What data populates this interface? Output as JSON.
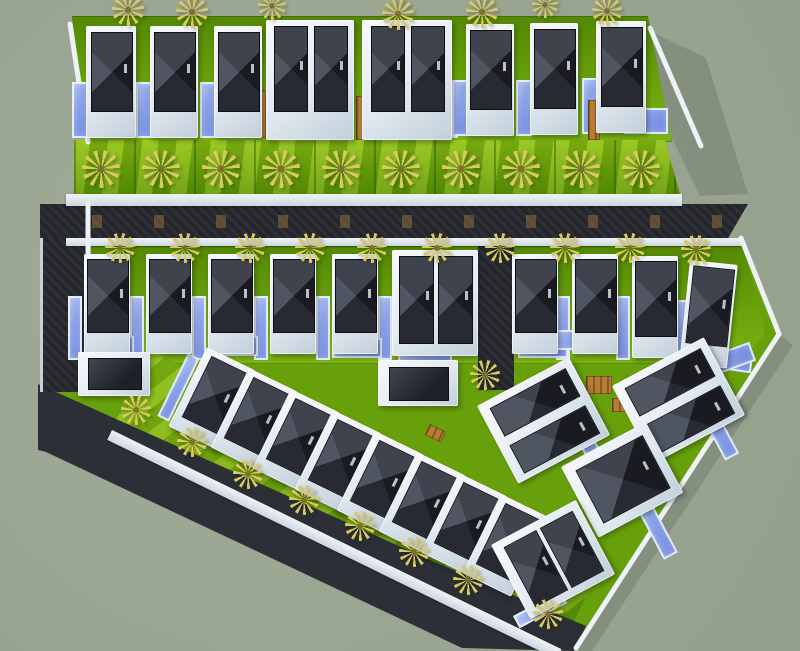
{
  "meta": {
    "description": "3D aerial top-down render of a tropical villa development master plan",
    "width": 800,
    "height": 651,
    "legend": {
      "top_row_villas": 8,
      "middle_row_villas": 10,
      "diagonal_row_villas": 8,
      "right_cluster_villas": 4,
      "garages": 2,
      "swimming_pools": 38,
      "palm_trees": 36
    }
  },
  "palette": {
    "background_sage": "#9aa592",
    "asphalt_road": "#26282f",
    "lawn_bright": "#7ab411",
    "lawn_dark": "#548804",
    "pool_blue": "#8aa1e8",
    "roof_dark": "#191b21",
    "roof_light_facet": "#4f5561",
    "villa_white": "#f7fafc",
    "wood_deck": "#b57d36",
    "palm_yellow": "#d9c95e",
    "sidewalk_white": "#f0f4f7"
  },
  "scene": {
    "greens": [
      {
        "kind": "backing",
        "rect": [
          72,
          16,
          600,
          126
        ],
        "clip": "polygon(0 0, 96% 0, 100% 100%, 2.7% 100%)"
      },
      {
        "kind": "strip",
        "rect": [
          74,
          140,
          606,
          54
        ],
        "clip": "polygon(0 0, 97.5% 0, 100% 100%, 0 100%)"
      },
      {
        "kind": "backing",
        "rect": [
          66,
          246,
          700,
          118
        ],
        "clip": "polygon(0 0, 96.8% 0, 100% 74%, 95.8% 100%, 0 100%)"
      },
      {
        "kind": "band",
        "rect": [
          150,
          350,
          500,
          100,
          26
        ]
      }
    ],
    "roads": {
      "left": {
        "id": "road-left",
        "rect": [
          40,
          204,
          46,
          188
        ]
      },
      "mid": {
        "id": "road-mid",
        "rect": [
          40,
          204,
          708,
          34
        ],
        "clip": "polygon(0 0, 100% 0, 97.2% 100%, 0 100%)"
      },
      "alley": {
        "id": "road-alley",
        "rect": [
          478,
          238,
          36,
          152
        ]
      }
    },
    "sidewalks": [
      [
        66,
        194,
        616,
        12
      ],
      [
        66,
        238,
        676,
        8
      ],
      [
        112,
        430,
        500,
        11,
        26
      ]
    ],
    "pools": [
      [
        72,
        82,
        16,
        56
      ],
      [
        136,
        82,
        16,
        56
      ],
      [
        200,
        82,
        16,
        56
      ],
      [
        300,
        112,
        46,
        26
      ],
      [
        412,
        112,
        46,
        26
      ],
      [
        452,
        80,
        16,
        56
      ],
      [
        516,
        80,
        16,
        56
      ],
      [
        582,
        78,
        16,
        56
      ],
      [
        624,
        108,
        44,
        26
      ],
      [
        68,
        296,
        14,
        64
      ],
      [
        130,
        296,
        14,
        64
      ],
      [
        192,
        296,
        14,
        64
      ],
      [
        254,
        296,
        14,
        64
      ],
      [
        316,
        296,
        14,
        64
      ],
      [
        378,
        296,
        14,
        64
      ],
      [
        556,
        296,
        14,
        64
      ],
      [
        616,
        296,
        14,
        64
      ],
      [
        676,
        300,
        14,
        64
      ],
      [
        84,
        336,
        50,
        20
      ],
      [
        208,
        336,
        50,
        20
      ],
      [
        332,
        338,
        50,
        20
      ],
      [
        398,
        352,
        54,
        20
      ],
      [
        518,
        338,
        50,
        20
      ],
      [
        700,
        346,
        54,
        20,
        8
      ],
      [
        188,
        353,
        13,
        70,
        26
      ],
      [
        230,
        374,
        13,
        70,
        26
      ],
      [
        272,
        395,
        13,
        70,
        26
      ],
      [
        314,
        416,
        13,
        70,
        26
      ],
      [
        356,
        437,
        13,
        70,
        26
      ],
      [
        398,
        458,
        13,
        70,
        26
      ],
      [
        440,
        479,
        13,
        70,
        26
      ],
      [
        482,
        500,
        13,
        70,
        26
      ],
      [
        563,
        414,
        16,
        84,
        -28
      ],
      [
        696,
        406,
        16,
        62,
        -28
      ],
      [
        631,
        498,
        16,
        70,
        -28
      ],
      [
        513,
        616,
        54,
        14,
        -28
      ],
      [
        691,
        363,
        62,
        20,
        -20
      ],
      [
        548,
        330,
        58,
        20
      ]
    ],
    "decks": [
      [
        252,
        90,
        14,
        48
      ],
      [
        356,
        96,
        14,
        44
      ],
      [
        588,
        100,
        12,
        40
      ],
      [
        586,
        376,
        26,
        18
      ],
      [
        612,
        398,
        20,
        14
      ],
      [
        430,
        424,
        18,
        12,
        26
      ]
    ],
    "buildings": [
      {
        "rect": [
          86,
          26,
          50,
          112
        ],
        "roofs": [
          [
            5,
            6,
            40,
            78
          ]
        ]
      },
      {
        "rect": [
          150,
          26,
          48,
          112
        ],
        "roofs": [
          [
            4,
            6,
            40,
            78
          ]
        ]
      },
      {
        "rect": [
          214,
          26,
          48,
          112
        ],
        "roofs": [
          [
            4,
            6,
            40,
            78
          ]
        ]
      },
      {
        "rect": [
          266,
          20,
          88,
          120
        ],
        "roofs": [
          [
            8,
            6,
            32,
            84
          ],
          [
            48,
            6,
            32,
            84
          ]
        ]
      },
      {
        "rect": [
          362,
          20,
          90,
          120
        ],
        "roofs": [
          [
            9,
            6,
            32,
            84
          ],
          [
            49,
            6,
            32,
            84
          ]
        ]
      },
      {
        "rect": [
          466,
          24,
          48,
          112
        ],
        "roofs": [
          [
            4,
            6,
            40,
            78
          ]
        ]
      },
      {
        "rect": [
          530,
          23,
          48,
          112
        ],
        "roofs": [
          [
            4,
            6,
            40,
            78
          ]
        ]
      },
      {
        "rect": [
          596,
          21,
          50,
          112
        ],
        "roofs": [
          [
            5,
            6,
            40,
            78
          ]
        ]
      },
      {
        "rect": [
          84,
          254,
          46,
          100
        ],
        "roofs": [
          [
            3,
            5,
            40,
            72
          ]
        ]
      },
      {
        "rect": [
          146,
          254,
          46,
          100
        ],
        "roofs": [
          [
            3,
            5,
            40,
            72
          ]
        ]
      },
      {
        "rect": [
          208,
          254,
          46,
          100
        ],
        "roofs": [
          [
            3,
            5,
            40,
            72
          ]
        ]
      },
      {
        "rect": [
          270,
          254,
          46,
          100
        ],
        "roofs": [
          [
            3,
            5,
            40,
            72
          ]
        ]
      },
      {
        "rect": [
          332,
          254,
          46,
          100
        ],
        "roofs": [
          [
            3,
            5,
            40,
            72
          ]
        ]
      },
      {
        "rect": [
          392,
          250,
          86,
          106
        ],
        "roofs": [
          [
            7,
            6,
            33,
            86
          ],
          [
            46,
            6,
            33,
            86
          ]
        ]
      },
      {
        "rect": [
          512,
          254,
          46,
          100
        ],
        "roofs": [
          [
            3,
            5,
            40,
            72
          ]
        ]
      },
      {
        "rect": [
          572,
          254,
          46,
          100
        ],
        "roofs": [
          [
            3,
            5,
            40,
            72
          ]
        ]
      },
      {
        "rect": [
          632,
          256,
          46,
          102
        ],
        "roofs": [
          [
            3,
            5,
            40,
            74
          ]
        ]
      },
      {
        "rect": [
          690,
          260,
          48,
          104,
          6
        ],
        "roofs": [
          [
            4,
            5,
            40,
            76
          ]
        ]
      },
      {
        "rect": [
          78,
          352,
          72,
          44
        ],
        "flat": true,
        "roofs": [
          [
            10,
            6,
            52,
            30
          ]
        ]
      },
      {
        "rect": [
          378,
          360,
          80,
          46
        ],
        "flat": true,
        "roofs": [
          [
            11,
            7,
            58,
            32
          ]
        ]
      },
      {
        "rect": [
          207,
          347,
          54,
          88,
          26
        ],
        "roofs": [
          [
            8,
            6,
            38,
            66
          ]
        ]
      },
      {
        "rect": [
          249,
          368,
          54,
          88,
          26
        ],
        "roofs": [
          [
            8,
            6,
            38,
            66
          ]
        ]
      },
      {
        "rect": [
          291,
          389,
          54,
          88,
          26
        ],
        "roofs": [
          [
            8,
            6,
            38,
            66
          ]
        ]
      },
      {
        "rect": [
          333,
          410,
          54,
          88,
          26
        ],
        "roofs": [
          [
            8,
            6,
            38,
            66
          ]
        ]
      },
      {
        "rect": [
          375,
          431,
          54,
          88,
          26
        ],
        "roofs": [
          [
            8,
            6,
            38,
            66
          ]
        ]
      },
      {
        "rect": [
          417,
          452,
          54,
          88,
          26
        ],
        "roofs": [
          [
            8,
            6,
            38,
            66
          ]
        ]
      },
      {
        "rect": [
          459,
          473,
          54,
          88,
          26
        ],
        "roofs": [
          [
            8,
            6,
            38,
            66
          ]
        ]
      },
      {
        "rect": [
          501,
          494,
          54,
          88,
          26
        ],
        "roofs": [
          [
            8,
            6,
            38,
            66
          ]
        ]
      },
      {
        "rect": [
          477,
          406,
          104,
          88,
          -28
        ],
        "roofs": [
          [
            10,
            8,
            84,
            30
          ],
          [
            10,
            50,
            84,
            30
          ]
        ]
      },
      {
        "rect": [
          612,
          386,
          104,
          88,
          -28
        ],
        "roofs": [
          [
            10,
            8,
            84,
            30
          ],
          [
            10,
            50,
            84,
            30
          ]
        ]
      },
      {
        "rect": [
          561,
          467,
          96,
          80,
          -28
        ],
        "roofs": [
          [
            11,
            10,
            74,
            58
          ]
        ]
      },
      {
        "rect": [
          491,
          545,
          96,
          84,
          -28
        ],
        "roofs": [
          [
            10,
            8,
            35,
            66
          ],
          [
            51,
            8,
            35,
            66
          ]
        ]
      }
    ],
    "palms": [
      [
        112,
        -6,
        32
      ],
      [
        176,
        -4,
        32
      ],
      [
        258,
        -8,
        28
      ],
      [
        382,
        -2,
        32
      ],
      [
        466,
        -4,
        32
      ],
      [
        532,
        -8,
        26
      ],
      [
        592,
        -4,
        30
      ],
      [
        82,
        150,
        38
      ],
      [
        142,
        150,
        38
      ],
      [
        202,
        150,
        38
      ],
      [
        262,
        150,
        38
      ],
      [
        322,
        150,
        38
      ],
      [
        382,
        150,
        38
      ],
      [
        442,
        150,
        38
      ],
      [
        502,
        150,
        38
      ],
      [
        562,
        150,
        38
      ],
      [
        622,
        150,
        38
      ],
      [
        105,
        233,
        30
      ],
      [
        170,
        233,
        30
      ],
      [
        235,
        233,
        30
      ],
      [
        295,
        233,
        30
      ],
      [
        357,
        233,
        30
      ],
      [
        422,
        233,
        30
      ],
      [
        485,
        233,
        30
      ],
      [
        550,
        233,
        30
      ],
      [
        615,
        233,
        30
      ],
      [
        681,
        235,
        30
      ],
      [
        470,
        360,
        30
      ],
      [
        121,
        395,
        30
      ],
      [
        177,
        427,
        30
      ],
      [
        233,
        459,
        30
      ],
      [
        289,
        485,
        30
      ],
      [
        345,
        511,
        30
      ],
      [
        399,
        537,
        30
      ],
      [
        453,
        565,
        30
      ],
      [
        533,
        599,
        30
      ]
    ],
    "svg": {
      "shadows": [
        "652,32 706,58 748,194 700,196 664,122",
        "779,334 793,345 588,657 576,648"
      ],
      "dev_green": "68,246 741,240 778,334 576,648 470,648 46,440 46,388 68,380",
      "road_diagonal": "38,384 270,488 430,560 586,626 574,651 462,648 250,548 46,452 38,450",
      "walls": [
        [
          70,
          24,
          88,
          142
        ],
        [
          650,
          28,
          701,
          146
        ],
        [
          741,
          238,
          779,
          334
        ],
        [
          779,
          334,
          576,
          648
        ],
        [
          88,
          204,
          88,
          392
        ]
      ]
    }
  }
}
